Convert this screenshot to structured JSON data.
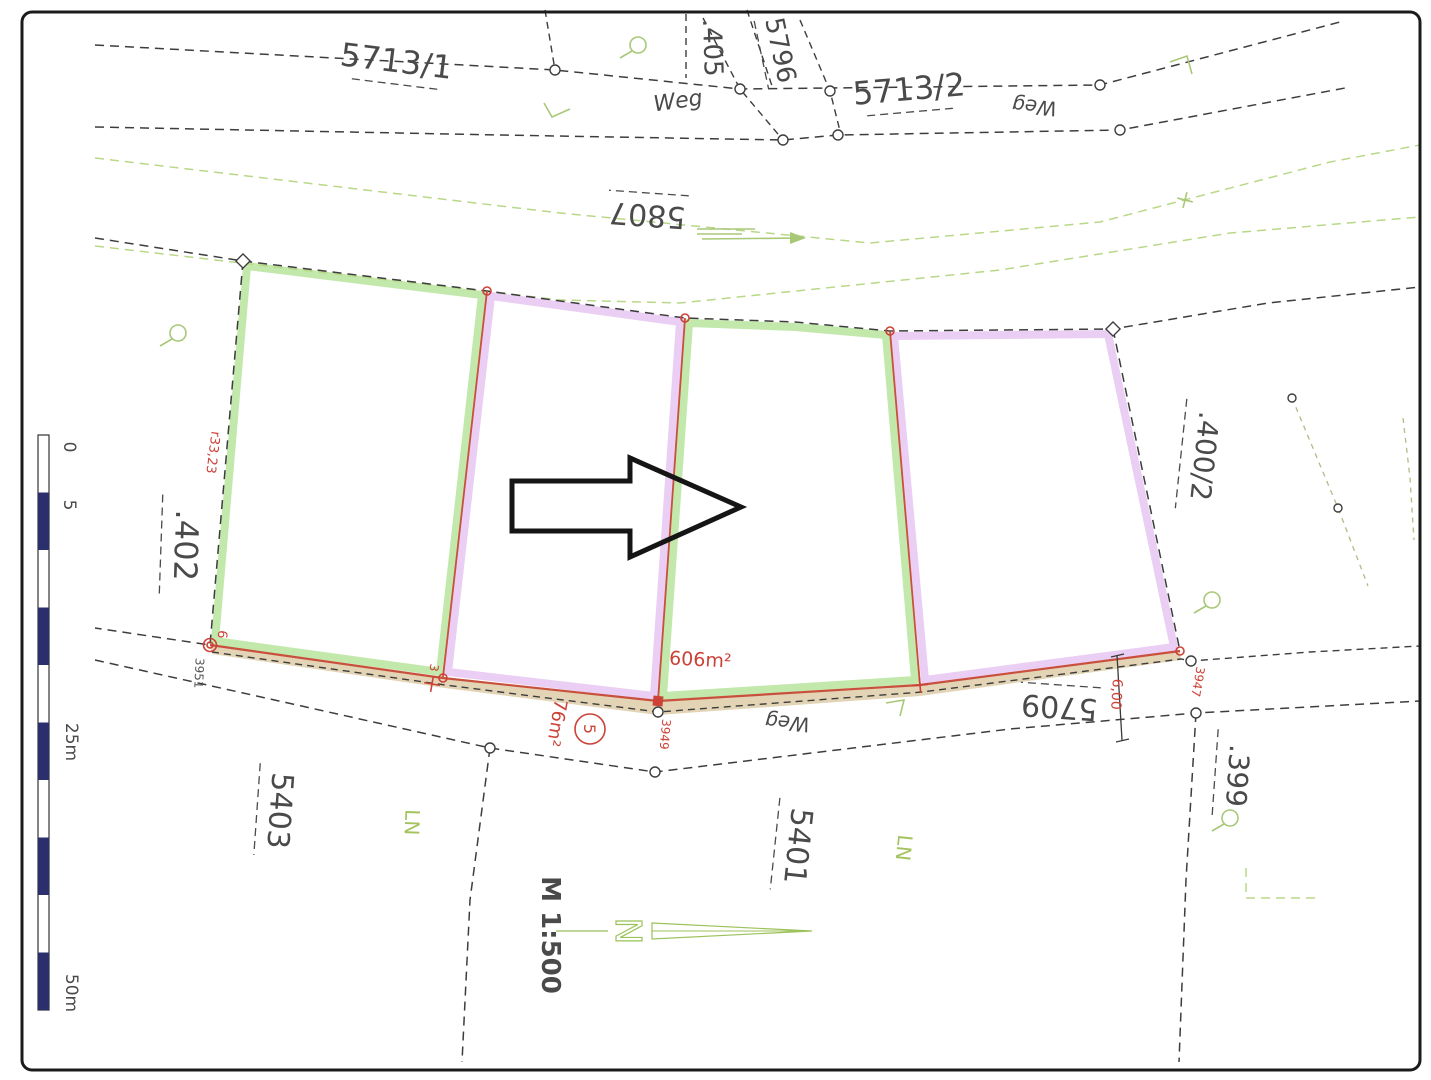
{
  "map": {
    "type": "cadastral-plan",
    "parcel_labels": {
      "p5713_1": "5713/1",
      "p405": ".405",
      "p5796": "5796",
      "p5713_2": "5713/2",
      "p5807": "5807",
      "p402": ".402",
      "p400_2": ".400/2",
      "p5709": "5709",
      "p399": ".399",
      "p5403": "5403",
      "p5401": "5401"
    },
    "road_labels": {
      "weg_top": "Weg",
      "weg_right": "Weg",
      "weg_bottom": "Weg"
    },
    "land_use_labels": {
      "ln_left": "LN",
      "ln_right": "LN"
    },
    "annotations_red": {
      "area_main": "606m²",
      "area_weg": "76m²",
      "circled": "5",
      "dist_left": "r33,23",
      "dist_weg": "6,00",
      "pt6": "6",
      "pt3": "3",
      "pt3947": "3947",
      "pt3949": "3949"
    },
    "point_labels": {
      "pt3951": "3951"
    },
    "scale": {
      "text": "M 1:500",
      "bar_ticks": {
        "t0": "0",
        "t5": "5",
        "t25": "25m",
        "t50": "50m"
      }
    },
    "north": {
      "letter": "N"
    },
    "colors": {
      "highlight_green": "#b9e49e",
      "highlight_purple": "#e8c9f2",
      "boundary_red": "#c8503c",
      "annotation_red": "#cc4237",
      "road_green": "#b8d888",
      "scalebar_navy": "#2b2f6e",
      "weg_strip_tan": "#dbc9a2",
      "text_gray": "#4a4a4a"
    }
  }
}
